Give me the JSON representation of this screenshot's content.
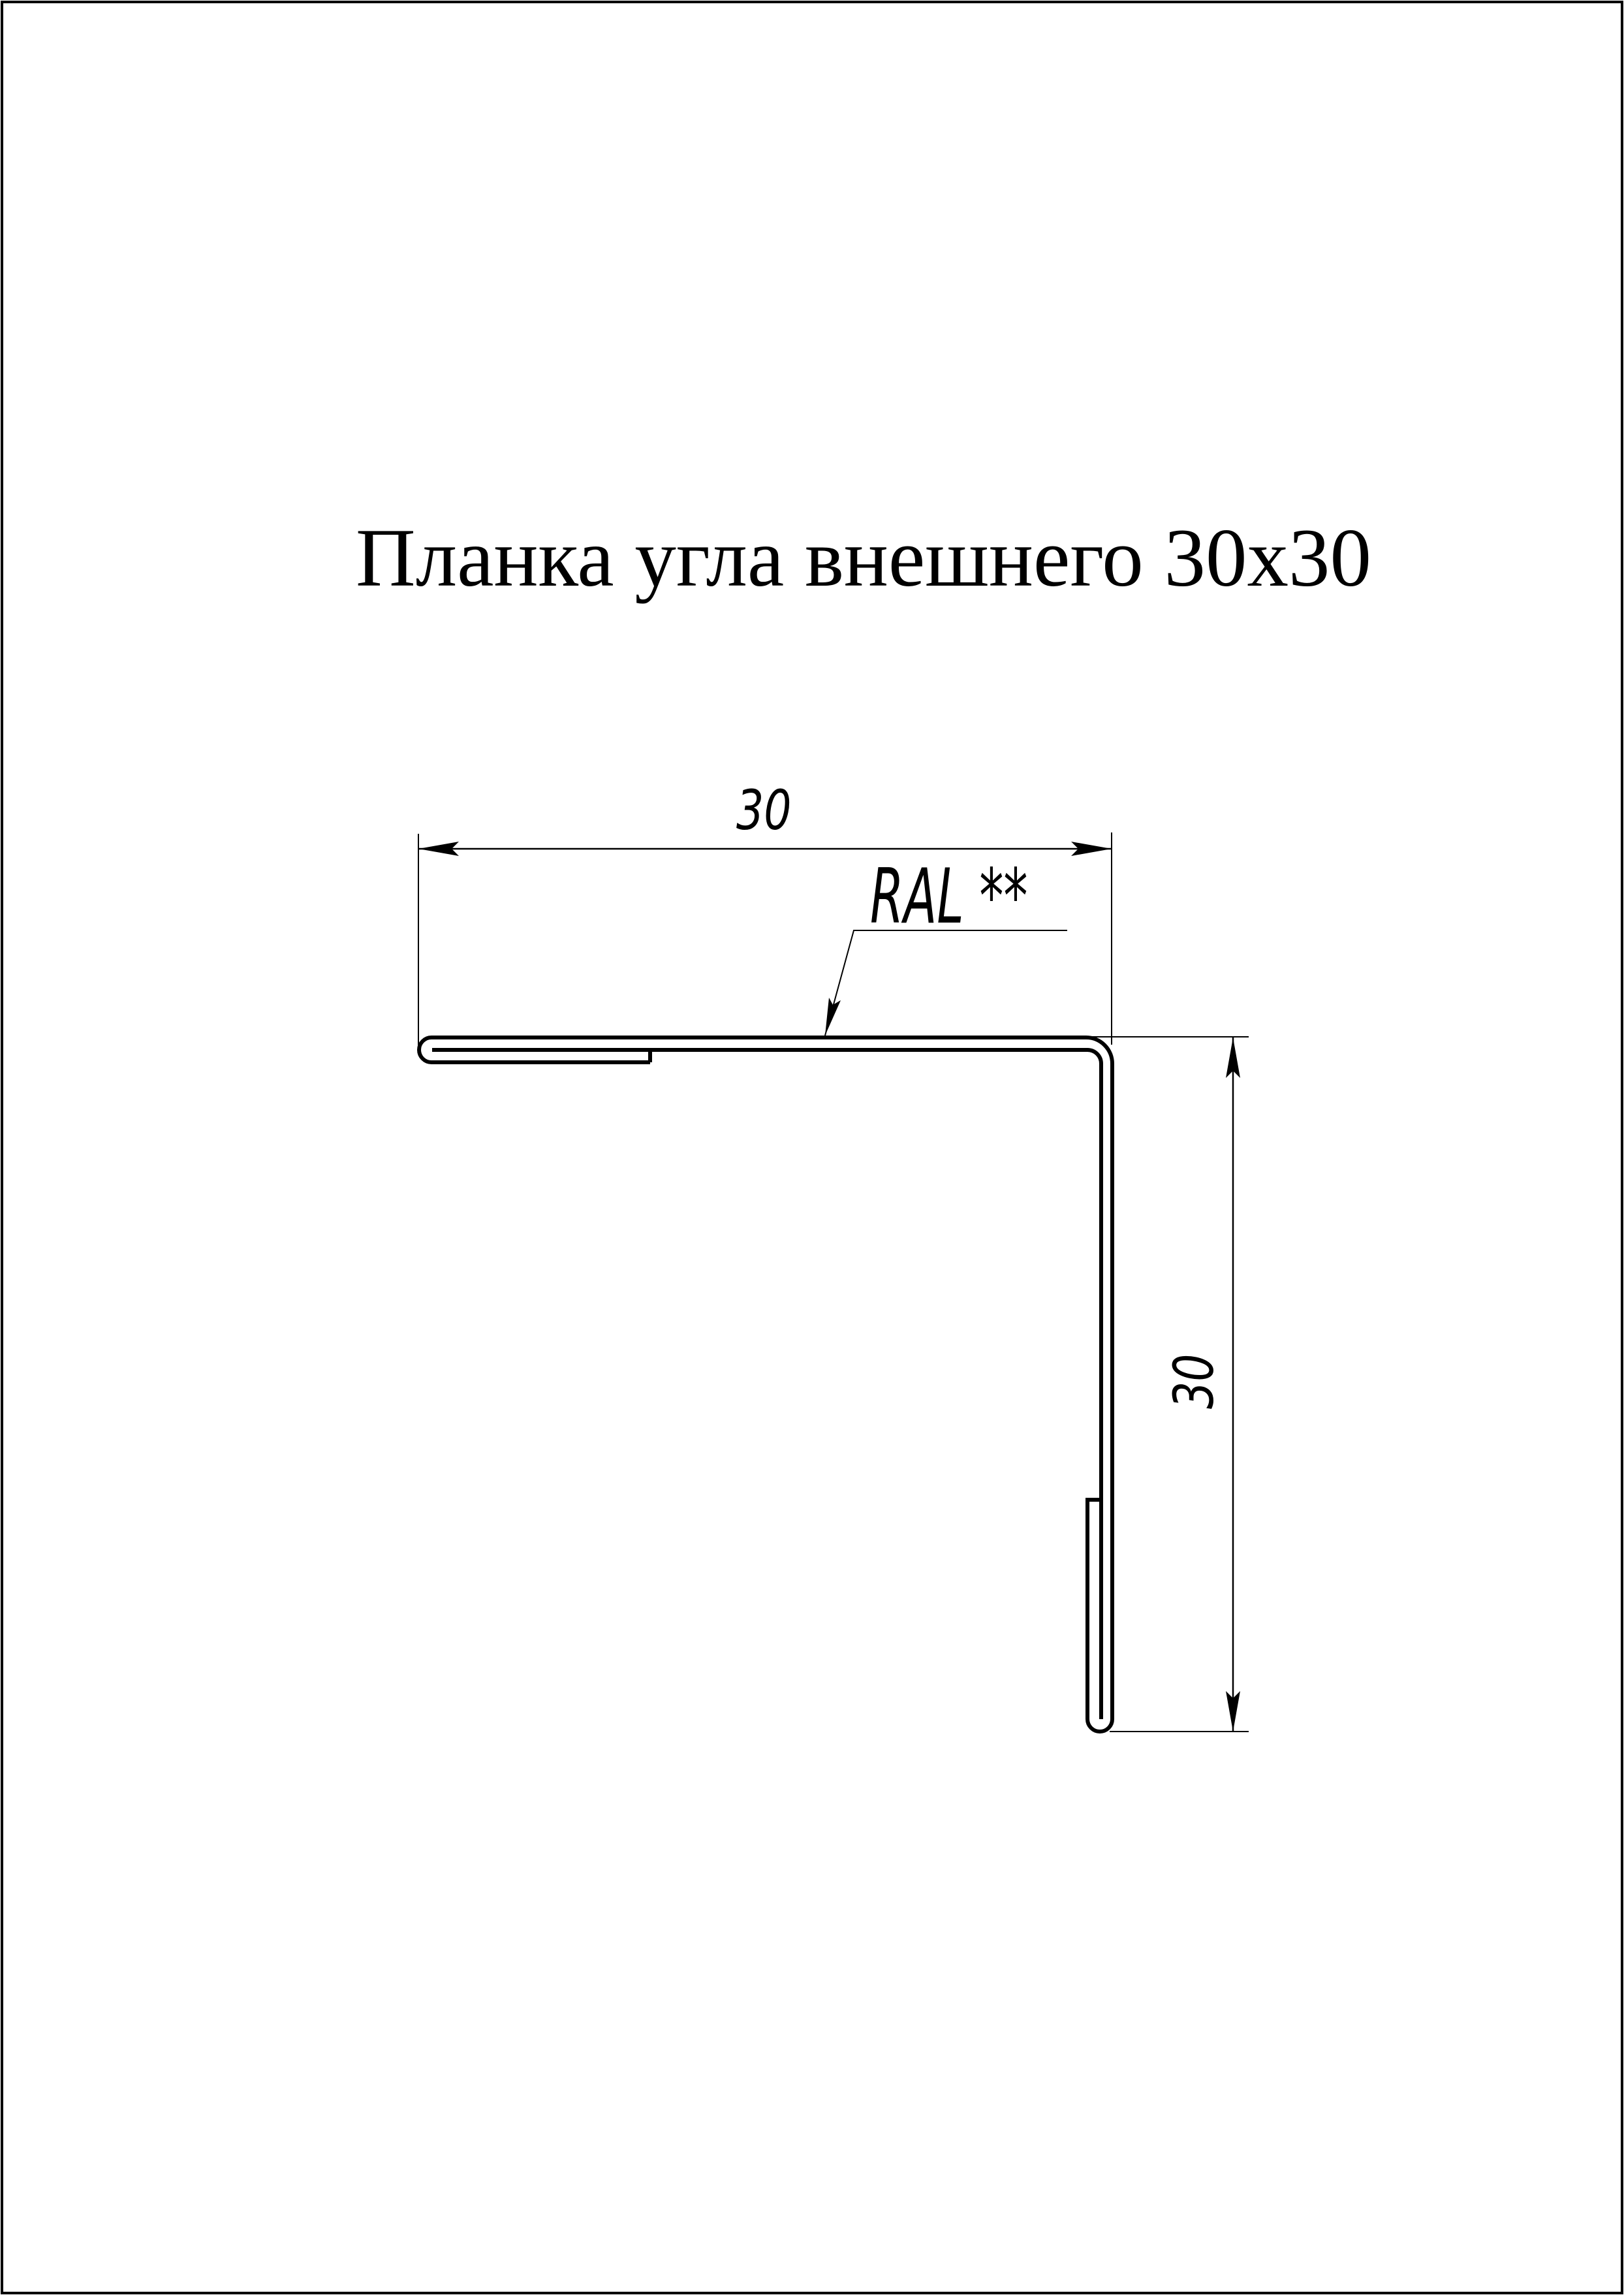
{
  "page": {
    "background": "#ffffff",
    "ink": "#000000"
  },
  "title": {
    "text": "Планка угла внешнего 30х30"
  },
  "drawing": {
    "width_dimension_label": "30",
    "height_dimension_label": "30",
    "coating_label": "RAL **"
  }
}
